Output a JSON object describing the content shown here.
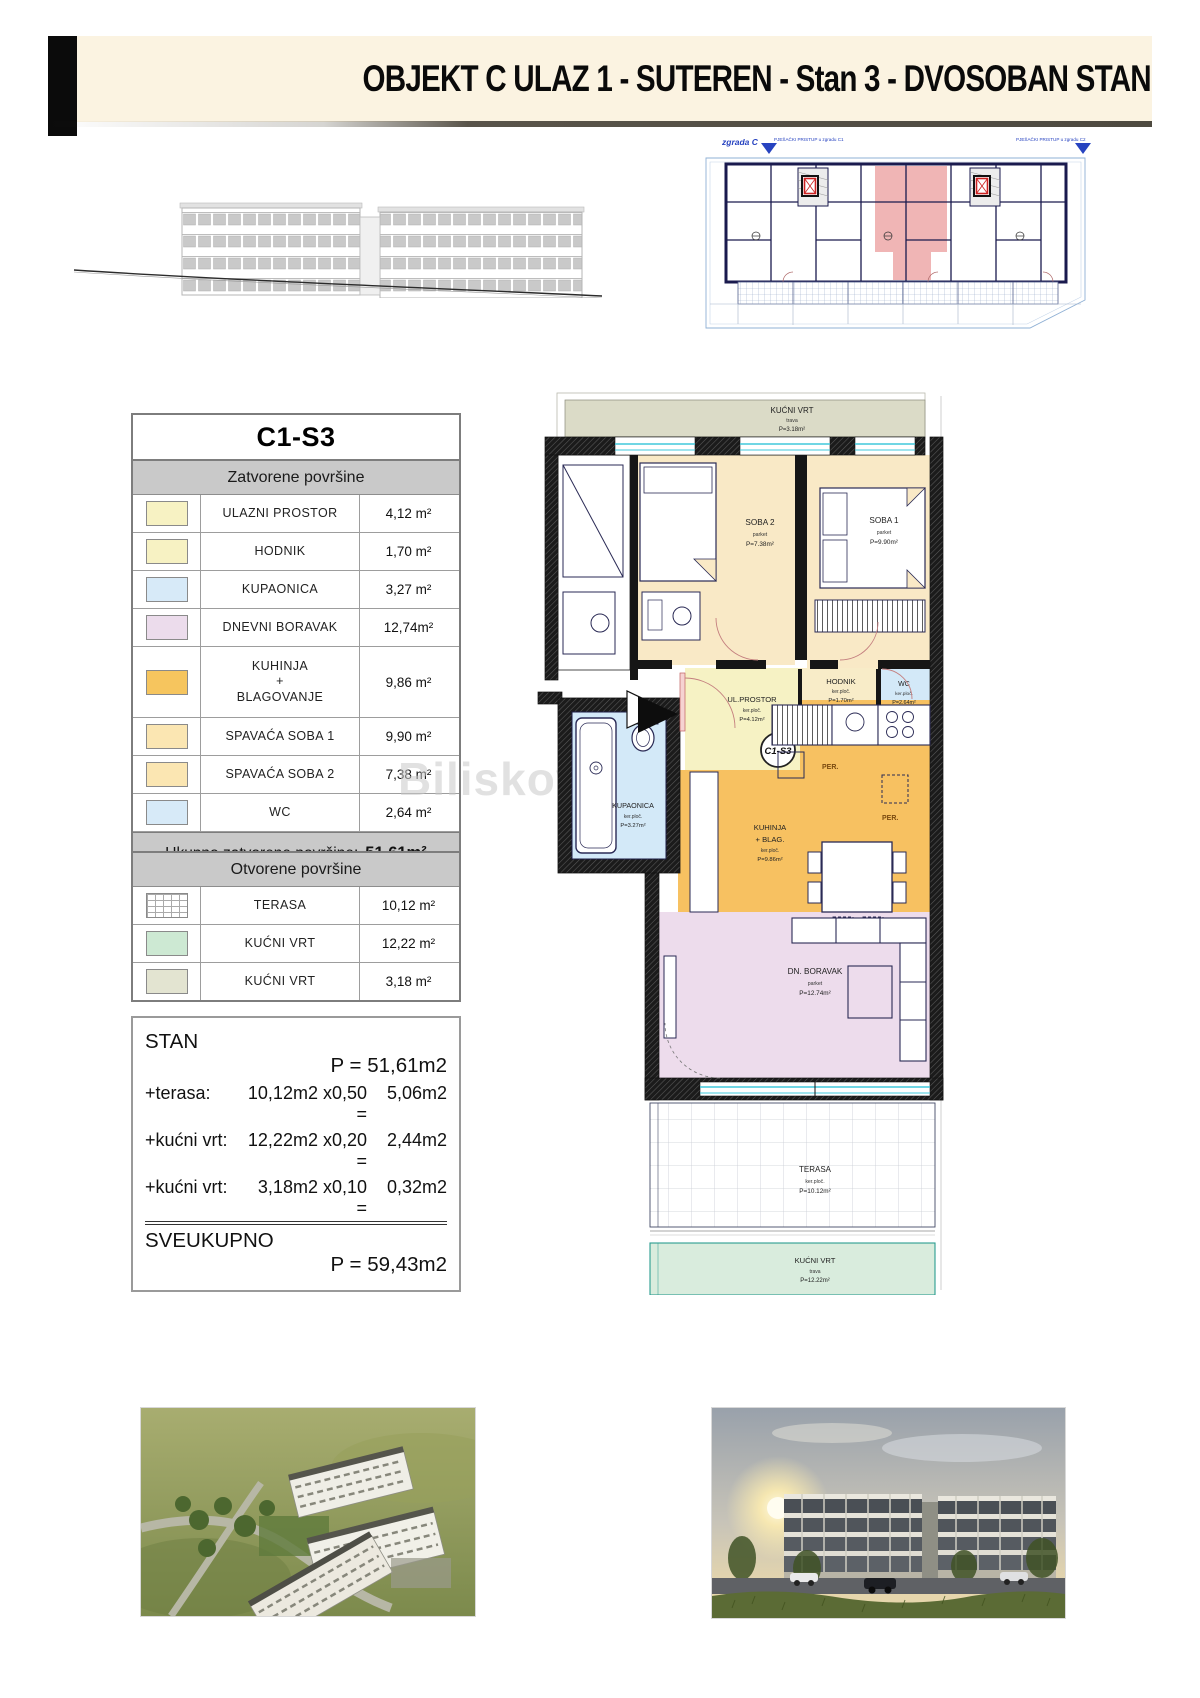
{
  "page": {
    "title": "OBJEKT C ULAZ 1 - SUTEREN - Stan 3 - DVOSOBAN STAN"
  },
  "watermark": "Biliskov",
  "site_plan": {
    "building_label": "zgrada C",
    "access1": "PJEŠAČKI PRISTUP u zgradu C1",
    "access2": "PJEŠAČKI PRISTUP u zgradu C2"
  },
  "unit_table": {
    "unit_id": "C1-S3",
    "closed_header": "Zatvorene površine",
    "closed_rows": [
      {
        "name": "ULAZNI PROSTOR",
        "area": "4,12 m²",
        "swatch": "#f7f2c3"
      },
      {
        "name": "HODNIK",
        "area": "1,70 m²",
        "swatch": "#f7f2c3"
      },
      {
        "name": "KUPAONICA",
        "area": "3,27 m²",
        "swatch": "#d7eaf8"
      },
      {
        "name": "DNEVNI BORAVAK",
        "area": "12,74m²",
        "swatch": "#ecdcec"
      },
      {
        "name": "KUHINJA",
        "name2": "+",
        "name3": "BLAGOVANJE",
        "area": "9,86 m²",
        "swatch": "#f6c55e"
      },
      {
        "name": "SPAVAĆA SOBA 1",
        "area": "9,90 m²",
        "swatch": "#fbe6b2"
      },
      {
        "name": "SPAVAĆA SOBA 2",
        "area": "7,38 m²",
        "swatch": "#fbe6b2"
      },
      {
        "name": "WC",
        "area": "2,64 m²",
        "swatch": "#d7eaf8"
      }
    ],
    "total_label": "Ukupno zatvorene površine:",
    "total_value": "51,61m²",
    "open_header": "Otvorene površine",
    "open_rows": [
      {
        "name": "TERASA",
        "area": "10,12 m²",
        "swatch": "grid"
      },
      {
        "name": "KUĆNI VRT",
        "area": "12,22 m²",
        "swatch": "#cde9d3"
      },
      {
        "name": "KUĆNI VRT",
        "area": "3,18 m²",
        "swatch": "#e3e4d1"
      }
    ]
  },
  "calc": {
    "rows": [
      {
        "label": "STAN",
        "mid": "",
        "val": "P = 51,61m2"
      },
      {
        "label": "+terasa:",
        "mid": "10,12m2 x0,50 =",
        "val": "5,06m2"
      },
      {
        "label": "+kućni vrt:",
        "mid": "12,22m2 x0,20 =",
        "val": "2,44m2"
      },
      {
        "label": "+kućni vrt:",
        "mid": "3,18m2 x0,10 =",
        "val": "0,32m2"
      },
      {
        "label": "SVEUKUPNO",
        "mid": "",
        "val": "P = 59,43m2"
      }
    ]
  },
  "plan": {
    "badge": "C1-S3",
    "per": "PER.",
    "garden_top": {
      "name": "KUĆNI VRT",
      "floor": "trava",
      "area": "P=3.18m²"
    },
    "soba2": {
      "name": "SOBA 2",
      "floor": "parket",
      "area": "P=7.38m²"
    },
    "soba1": {
      "name": "SOBA 1",
      "floor": "parket",
      "area": "P=9.90m²"
    },
    "ulaz": {
      "name": "UL.PROSTOR",
      "floor": "ker.ploč.",
      "area": "P=4.12m²"
    },
    "hodnik": {
      "name": "HODNIK",
      "floor": "ker.ploč.",
      "area": "P=1.70m²"
    },
    "wc": {
      "name": "WC",
      "floor": "ker.ploč.",
      "area": "P=2.64m²"
    },
    "kupaonica": {
      "name": "KUPAONICA",
      "floor": "ker.ploč.",
      "area": "P=3.27m²"
    },
    "kuhinja": {
      "name": "KUHINJA",
      "name2": "+ BLAG.",
      "floor": "ker.ploč.",
      "area": "P=9.86m²"
    },
    "boravak": {
      "name": "DN. BORAVAK",
      "floor": "parket",
      "area": "P=12.74m²"
    },
    "terasa": {
      "name": "TERASA",
      "floor": "ker.ploč.",
      "area": "P=10.12m²"
    },
    "garden_bottom": {
      "name": "KUĆNI VRT",
      "floor": "trava",
      "area": "P=12.22m²"
    }
  },
  "colors": {
    "header_band": "#fbf3e1",
    "table_header": "#c9c9c9",
    "room_bedroom": "#f9e9c6",
    "room_entry": "#f6f2c4",
    "room_bath": "#d3e9f8",
    "room_kitchen": "#f7c161",
    "room_living": "#eddcec",
    "garden_green": "#d9ecdd",
    "garden_olive": "#dbdbc7",
    "window_cyan": "#40c8dc",
    "highlight_unit_pink": "#f0b5b5",
    "elevator_red": "#cc2222",
    "siteplan_navy": "#1a1a4e"
  }
}
